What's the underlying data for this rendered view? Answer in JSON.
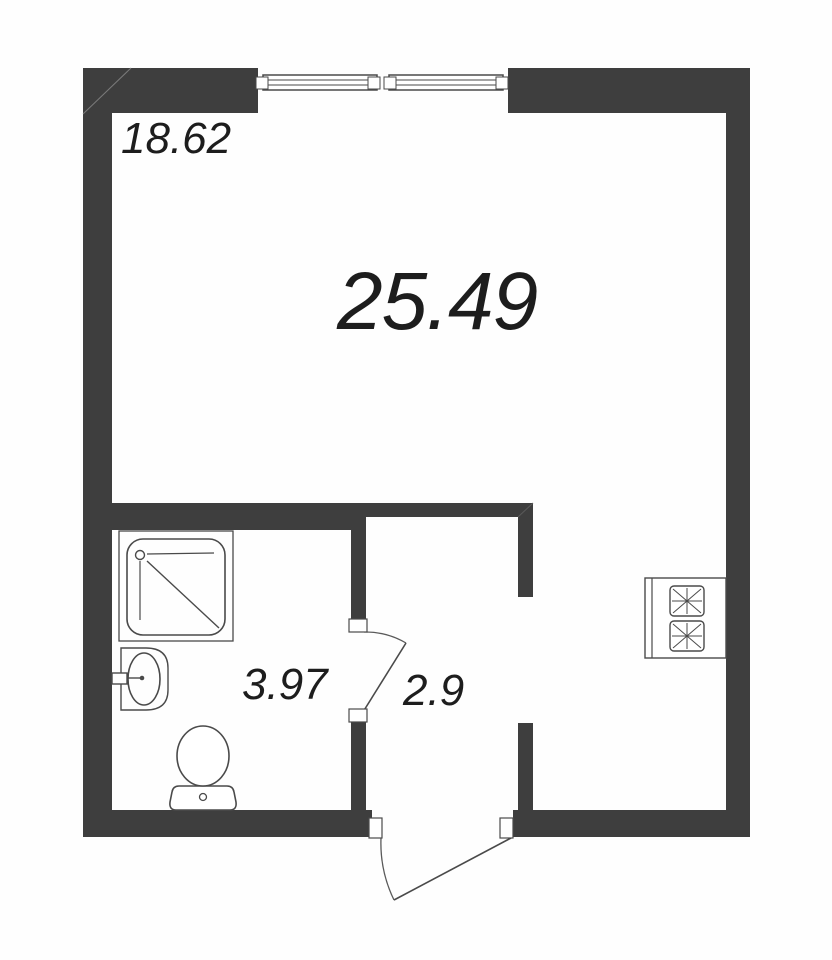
{
  "plan": {
    "type": "studio-apartment-floor-plan",
    "areas": {
      "living_room": "18.62",
      "total": "25.49",
      "bathroom": "3.97",
      "hallway": "2.9"
    },
    "fixtures": [
      "window",
      "shower-tray",
      "washbasin",
      "toilet",
      "stove",
      "bathroom-door",
      "entrance-door"
    ],
    "colors": {
      "wall": "#3e3e3e",
      "line": "#4a4a4a",
      "text": "#1d1d1d",
      "background": "#ffffff"
    }
  }
}
